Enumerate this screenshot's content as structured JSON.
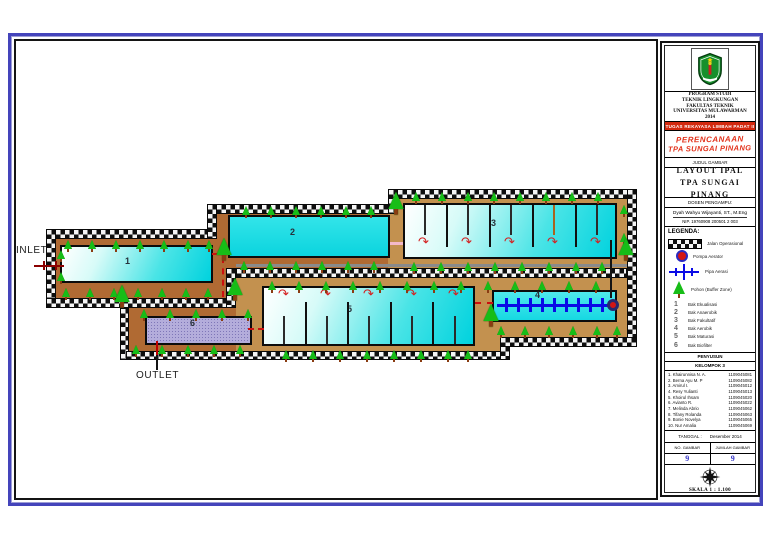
{
  "titleblock": {
    "institution": [
      "PROGRAM STUDI",
      "TEKNIK LINGKUNGAN",
      "FAKULTAS TEKNIK",
      "UNIVERSITAS MULAWARMAN",
      "2014"
    ],
    "assignment": "TUGAS  REKAYASA LIMBAH PADAT II",
    "project_line1": "PERENCANAAN",
    "project_line2": "TPA SUNGAI PINANG",
    "judul_gambar_label": "JUDUL GAMBAR",
    "title_line1": "LAYOUT IPAL",
    "title_line2": "TPA SUNGAI PINANG",
    "dosen_label": "DOSEN PENGAMPU:",
    "dosen_name": "Dyah Wahyu Wijayanti, ST., M.Eng",
    "dosen_nip": "NIP. 19760908 200501 2 003",
    "legend_label": "LEGENDA:",
    "legend_items": [
      {
        "icon": "road-icon",
        "label": "Jalan Operasional"
      },
      {
        "icon": "pump-icon",
        "label": "Pompa Aerator"
      },
      {
        "icon": "pipe-icon",
        "label": "Pipa Aerasi"
      },
      {
        "icon": "tree-icon",
        "label": "Pohon (Buffer Zone)"
      }
    ],
    "legend_numbers": [
      {
        "num": "1",
        "label": "Bak Ekualisasi"
      },
      {
        "num": "2",
        "label": "Bak Anaerobik"
      },
      {
        "num": "3",
        "label": "Bak Fakultatif"
      },
      {
        "num": "4",
        "label": "Bak Aerobik"
      },
      {
        "num": "5",
        "label": "Bak Maturasi"
      },
      {
        "num": "6",
        "label": "Bak Biofilter"
      }
    ],
    "penyusun_label": "PENYUSUN",
    "group_label": "KELOMPOK 3",
    "members": [
      {
        "name": "1. Khairunnisa N. A.",
        "nim": "1109045081"
      },
      {
        "name": "2. Berna Ayu M. P",
        "nim": "1109045082"
      },
      {
        "name": "3. Amirul I.",
        "nim": "1109045012"
      },
      {
        "name": "4. Resy Yulianti",
        "nim": "1109045013"
      },
      {
        "name": "5. Khoirul Ihsam",
        "nim": "1109045020"
      },
      {
        "name": "6. Avianto R.",
        "nim": "1109045022"
      },
      {
        "name": "7. Melinda Abrio",
        "nim": "1109045062"
      },
      {
        "name": "8. Tifany Rolanda",
        "nim": "1109045063"
      },
      {
        "name": "9. Bonie Novelya",
        "nim": "1109045065"
      },
      {
        "name": "10. Nur Amalia",
        "nim": "1109045069"
      }
    ],
    "tanggal_label": "TANGGAL :",
    "tanggal_value": "Desember 2014",
    "no_gambar_label": "NO. GAMBAR",
    "no_gambar_value": "9",
    "jumlah_gambar_label": "JUMLAH GAMBAR",
    "jumlah_gambar_value": "9",
    "skala": "SKALA 1 : 1.100"
  },
  "plan": {
    "inlet_label": "INLET",
    "outlet_label": "OUTLET",
    "colors": {
      "1": "#b06a33",
      "2": "#c3914f"
    },
    "grounds": [
      [
        46,
        229,
        180,
        79,
        1
      ],
      [
        120,
        298,
        160,
        62,
        1
      ],
      [
        207,
        204,
        190,
        74,
        1
      ],
      [
        388,
        189,
        249,
        89,
        2
      ],
      [
        236,
        268,
        274,
        92,
        2
      ],
      [
        500,
        268,
        137,
        79,
        2
      ]
    ],
    "roads": [
      [
        46,
        229,
        170,
        10
      ],
      [
        207,
        204,
        190,
        10
      ],
      [
        388,
        189,
        248,
        10
      ],
      [
        46,
        229,
        10,
        79
      ],
      [
        207,
        204,
        10,
        35
      ],
      [
        388,
        189,
        10,
        25
      ],
      [
        627,
        189,
        10,
        158
      ],
      [
        46,
        298,
        190,
        10
      ],
      [
        226,
        268,
        10,
        40
      ],
      [
        236,
        268,
        391,
        10
      ],
      [
        120,
        308,
        9,
        52
      ],
      [
        126,
        351,
        384,
        9
      ],
      [
        500,
        337,
        10,
        23
      ],
      [
        500,
        337,
        137,
        10
      ]
    ],
    "gray_bars": [
      [
        236,
        264,
        391,
        3,
        "#8a8a8a"
      ]
    ],
    "basins": [
      {
        "num": "1",
        "cls": "grad",
        "x": 60,
        "y": 245,
        "w": 153,
        "h": 38,
        "nx": 125,
        "ny": 256
      },
      {
        "num": "2",
        "cls": "flat",
        "x": 228,
        "y": 215,
        "w": 162,
        "h": 43,
        "nx": 290,
        "ny": 227
      },
      {
        "num": "3",
        "cls": "grad",
        "x": 403,
        "y": 203,
        "w": 214,
        "h": 56,
        "nx": 491,
        "ny": 218
      },
      {
        "num": "4",
        "cls": "aero",
        "x": 492,
        "y": 290,
        "w": 125,
        "h": 32,
        "nx": 535,
        "ny": 290
      },
      {
        "num": "5",
        "cls": "grad",
        "x": 262,
        "y": 286,
        "w": 213,
        "h": 60,
        "nx": 347,
        "ny": 304
      },
      {
        "num": "6",
        "cls": "bio",
        "x": 145,
        "y": 316,
        "w": 107,
        "h": 29,
        "nx": 190,
        "ny": 318
      }
    ],
    "baffles": [
      [
        446,
        205,
        42,
        "#101010"
      ],
      [
        489,
        205,
        42,
        "#101010"
      ],
      [
        532,
        205,
        42,
        "#101010"
      ],
      [
        575,
        205,
        42,
        "#101010"
      ],
      [
        424,
        205,
        30,
        "#2a2a2a"
      ],
      [
        467,
        205,
        30,
        "#2a2a2a"
      ],
      [
        510,
        205,
        30,
        "#2a2a2a"
      ],
      [
        596,
        205,
        30,
        "#2a2a2a"
      ],
      [
        553,
        205,
        30,
        "#a8641f"
      ],
      [
        305,
        302,
        42,
        "#101010"
      ],
      [
        347,
        302,
        42,
        "#101010"
      ],
      [
        390,
        302,
        42,
        "#101010"
      ],
      [
        432,
        302,
        42,
        "#101010"
      ],
      [
        283,
        316,
        28,
        "#2a2a2a"
      ],
      [
        326,
        316,
        28,
        "#2a2a2a"
      ],
      [
        368,
        316,
        28,
        "#2a2a2a"
      ],
      [
        411,
        316,
        28,
        "#2a2a2a"
      ],
      [
        454,
        316,
        28,
        "#2a2a2a"
      ]
    ],
    "arrow_glyph": "↷",
    "arrow_rows": [
      {
        "y": 236,
        "xs": [
          418,
          461,
          504,
          547,
          590
        ]
      },
      {
        "y": 288,
        "xs": [
          278,
          320,
          363,
          406,
          448
        ]
      }
    ],
    "aeration": {
      "line": [
        497,
        304,
        116
      ],
      "ticks_y": 298,
      "ticks_h": 14,
      "ticks_x": [
        505,
        517,
        529,
        541,
        553,
        565,
        577,
        589,
        601
      ],
      "pump": [
        607,
        299
      ]
    },
    "pipes": [
      [
        34,
        265,
        30,
        2,
        "r"
      ],
      [
        43,
        261,
        2,
        9,
        "r"
      ],
      [
        55,
        261,
        2,
        9,
        "r"
      ],
      [
        156,
        341,
        2,
        14,
        "r2"
      ],
      [
        156,
        355,
        2,
        15,
        "k"
      ],
      [
        212,
        253,
        18,
        0,
        "d"
      ],
      [
        222,
        257,
        0,
        40,
        "dv"
      ],
      [
        390,
        242,
        13,
        3,
        "p"
      ],
      [
        610,
        240,
        2,
        58,
        "k"
      ],
      [
        475,
        302,
        18,
        0,
        "d"
      ],
      [
        248,
        328,
        16,
        0,
        "d"
      ]
    ],
    "tree_rows": [
      {
        "y": 240,
        "xs": [
          64,
          88,
          112,
          136,
          160,
          184,
          205
        ]
      },
      {
        "y": 288,
        "xs": [
          62,
          86,
          110,
          134,
          158,
          182,
          204
        ]
      },
      {
        "y": 250,
        "xs": [
          57
        ]
      },
      {
        "y": 272,
        "xs": [
          57
        ]
      },
      {
        "y": 206,
        "xs": [
          242,
          267,
          292,
          317,
          342,
          367
        ]
      },
      {
        "y": 261,
        "xs": [
          240,
          266,
          292,
          318,
          344,
          370
        ]
      },
      {
        "y": 192,
        "xs": [
          412,
          438,
          464,
          490,
          516,
          542,
          568,
          594
        ]
      },
      {
        "y": 262,
        "xs": [
          410,
          437,
          464,
          491,
          518,
          545,
          572,
          598
        ]
      },
      {
        "y": 281,
        "xs": [
          268,
          295,
          322,
          349,
          376,
          403,
          430,
          457,
          484,
          511,
          538,
          565,
          592
        ]
      },
      {
        "y": 350,
        "xs": [
          282,
          309,
          336,
          363,
          390,
          417,
          444,
          464
        ]
      },
      {
        "y": 326,
        "xs": [
          497,
          521,
          545,
          569,
          593,
          613
        ]
      },
      {
        "y": 309,
        "xs": [
          140,
          166,
          192,
          218,
          244
        ]
      },
      {
        "y": 345,
        "xs": [
          132,
          158,
          184,
          210,
          236
        ]
      },
      {
        "y": 205,
        "xs": [
          620
        ]
      },
      {
        "y": 233,
        "xs": [
          620
        ]
      }
    ],
    "big_trees": [
      [
        220,
        246
      ],
      [
        231,
        286
      ],
      [
        118,
        293
      ],
      [
        392,
        200
      ],
      [
        622,
        246
      ],
      [
        487,
        312
      ]
    ]
  }
}
